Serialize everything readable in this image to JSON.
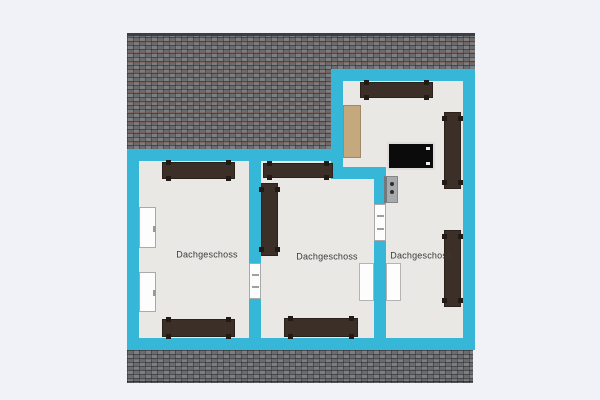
{
  "app": {
    "view_title": "Dachgeschoss floor plan"
  },
  "palette": {
    "background": "#f1f2f7",
    "wall": "#36b7d7",
    "floor": "#e9e8e5",
    "roof_base": "#747579",
    "roof_ridge": "#3d3e42",
    "furniture_brown": "#3b2f27",
    "furniture_feet": "#221b15",
    "dresser_beige": "#c4a87e",
    "tv_black": "#0b0b0b",
    "appliance_gray": "#a7aaad",
    "opening_white": "#fdfdfd",
    "opening_border": "#a9a9a9",
    "label_color": "#3a3a3a"
  },
  "floorplan": {
    "roof": {
      "top": {
        "x": 127,
        "y": 33,
        "w": 348,
        "h": 116
      },
      "ridge": {
        "x": 127,
        "y": 33,
        "w": 348,
        "h": 3
      },
      "bottom": {
        "x": 127,
        "y": 350,
        "w": 346,
        "h": 33
      }
    },
    "floors": [
      {
        "x": 139,
        "y": 161,
        "w": 110,
        "h": 177
      },
      {
        "x": 261,
        "y": 161,
        "w": 113,
        "h": 177
      },
      {
        "x": 343,
        "y": 81,
        "w": 120,
        "h": 98
      },
      {
        "x": 386,
        "y": 179,
        "w": 77,
        "h": 159
      }
    ],
    "walls": [
      {
        "x": 127,
        "y": 149,
        "w": 12,
        "h": 201
      },
      {
        "x": 127,
        "y": 338,
        "w": 348,
        "h": 12
      },
      {
        "x": 127,
        "y": 149,
        "w": 216,
        "h": 12
      },
      {
        "x": 331,
        "y": 69,
        "w": 12,
        "h": 110
      },
      {
        "x": 331,
        "y": 69,
        "w": 144,
        "h": 12
      },
      {
        "x": 463,
        "y": 69,
        "w": 12,
        "h": 281
      },
      {
        "x": 331,
        "y": 167,
        "w": 55,
        "h": 12
      },
      {
        "x": 374,
        "y": 167,
        "w": 12,
        "h": 183
      },
      {
        "x": 249,
        "y": 149,
        "w": 12,
        "h": 201
      }
    ],
    "openings": [
      {
        "kind": "window",
        "variant": "side",
        "x": 139,
        "y": 207,
        "w": 17,
        "h": 41
      },
      {
        "kind": "window",
        "variant": "side",
        "x": 139,
        "y": 272,
        "w": 17,
        "h": 40
      },
      {
        "kind": "door",
        "variant": "onwall",
        "x": 249,
        "y": 263,
        "w": 12,
        "h": 36
      },
      {
        "kind": "window",
        "variant": "onwall",
        "x": 374,
        "y": 204,
        "w": 12,
        "h": 37
      },
      {
        "kind": "door-panel",
        "variant": "panel",
        "x": 359,
        "y": 263,
        "w": 15,
        "h": 38
      },
      {
        "kind": "door-panel",
        "variant": "panel",
        "x": 386,
        "y": 263,
        "w": 15,
        "h": 38
      }
    ],
    "furniture": [
      {
        "type": "sofa",
        "orient": "h",
        "x": 162,
        "y": 162,
        "w": 73,
        "h": 17
      },
      {
        "type": "sofa",
        "orient": "h",
        "x": 162,
        "y": 319,
        "w": 73,
        "h": 18
      },
      {
        "type": "sofa",
        "orient": "h",
        "x": 263,
        "y": 163,
        "w": 70,
        "h": 15
      },
      {
        "type": "cabinet",
        "orient": "v",
        "x": 261,
        "y": 183,
        "w": 17,
        "h": 73
      },
      {
        "type": "sofa",
        "orient": "h",
        "x": 284,
        "y": 318,
        "w": 74,
        "h": 19
      },
      {
        "type": "sofa",
        "orient": "h",
        "x": 360,
        "y": 82,
        "w": 73,
        "h": 16
      },
      {
        "type": "dresser",
        "x": 343,
        "y": 105,
        "w": 18,
        "h": 53
      },
      {
        "type": "radiator",
        "orient": "v",
        "x": 444,
        "y": 112,
        "w": 17,
        "h": 77
      },
      {
        "type": "tv",
        "x": 387,
        "y": 142,
        "w": 48,
        "h": 28
      },
      {
        "type": "appliance",
        "x": 384,
        "y": 176,
        "w": 14,
        "h": 27
      },
      {
        "type": "radiator",
        "orient": "v",
        "x": 444,
        "y": 230,
        "w": 17,
        "h": 77
      }
    ],
    "labels": [
      {
        "text": "Dachgeschoss",
        "cx": 207,
        "cy": 255
      },
      {
        "text": "Dachgeschoss",
        "cx": 327,
        "cy": 257
      },
      {
        "text": "Dachgeschoss",
        "cx": 421,
        "cy": 256
      }
    ]
  }
}
